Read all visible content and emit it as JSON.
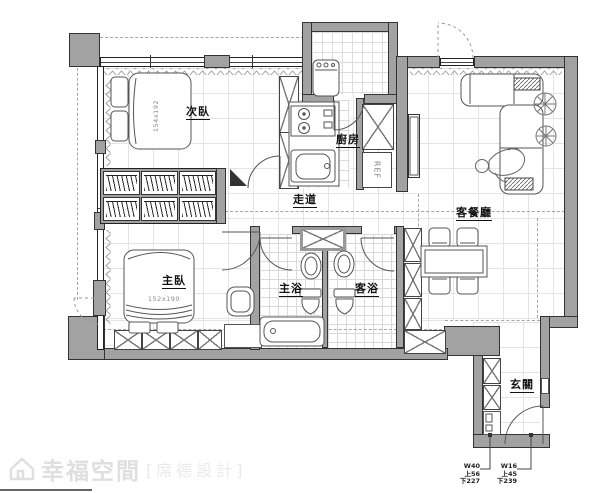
{
  "colors": {
    "wall": "#a2a2a2",
    "wall_border": "#333333",
    "furniture_line": "#555555",
    "grid": "#e4e4e4",
    "tile_grid": "#d9d9d9",
    "label": "#111111",
    "watermark": "#dfdfdf"
  },
  "rooms": {
    "secondary_bedroom": {
      "label": "次臥",
      "bed_size": "154x192"
    },
    "kitchen": {
      "label": "廚房"
    },
    "corridor": {
      "label": "走道"
    },
    "living_dining": {
      "label": "客餐廳"
    },
    "master_bedroom": {
      "label": "主臥",
      "bed_size": "152x190"
    },
    "master_bath": {
      "label": "主浴"
    },
    "guest_bath": {
      "label": "客浴"
    },
    "entry": {
      "label": "玄關"
    }
  },
  "appliances": {
    "fridge_label": "REF"
  },
  "dimensions": {
    "left": {
      "w": "W40",
      "top": "上56",
      "bottom": "下227"
    },
    "right": {
      "w": "W16",
      "top": "上45",
      "bottom": "下239"
    }
  },
  "watermark": {
    "brand": "幸福空間",
    "designer": "[席德設計]"
  }
}
